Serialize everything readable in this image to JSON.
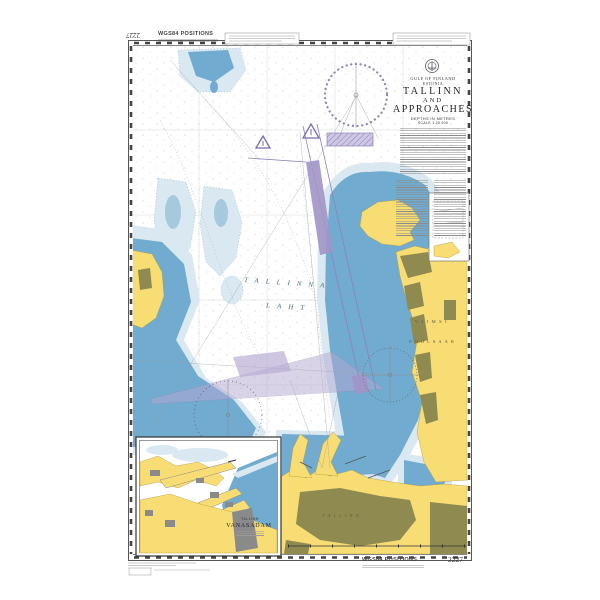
{
  "chart": {
    "number": "2227",
    "positions_note": "WGS84 POSITIONS",
    "title_block": {
      "sea_area": "GULF OF FINLAND",
      "country": "ESTONIA",
      "title1": "TALLINN",
      "title2": "AND",
      "title3": "APPROACHES",
      "depths": "DEPTHS IN METRES",
      "scale": "SCALE 1:25 000"
    },
    "labels": {
      "bay_word1": "TALLINNA",
      "bay_word2": "LAHT",
      "peninsula_word1": "VIIMSI",
      "peninsula_word2": "POOLSAAR",
      "city": "TALLINN"
    },
    "inset": {
      "place": "TALLINN",
      "name": "VANASADAM"
    },
    "footer": {
      "positions_note": "WGS84 POSITIONS",
      "number": "2227"
    },
    "colors": {
      "land": "#f8dc74",
      "built_up": "#8f8a50",
      "shallow_water": "#d9e8f1",
      "water": "#72abd0",
      "magenta": "#8f81b8"
    }
  }
}
